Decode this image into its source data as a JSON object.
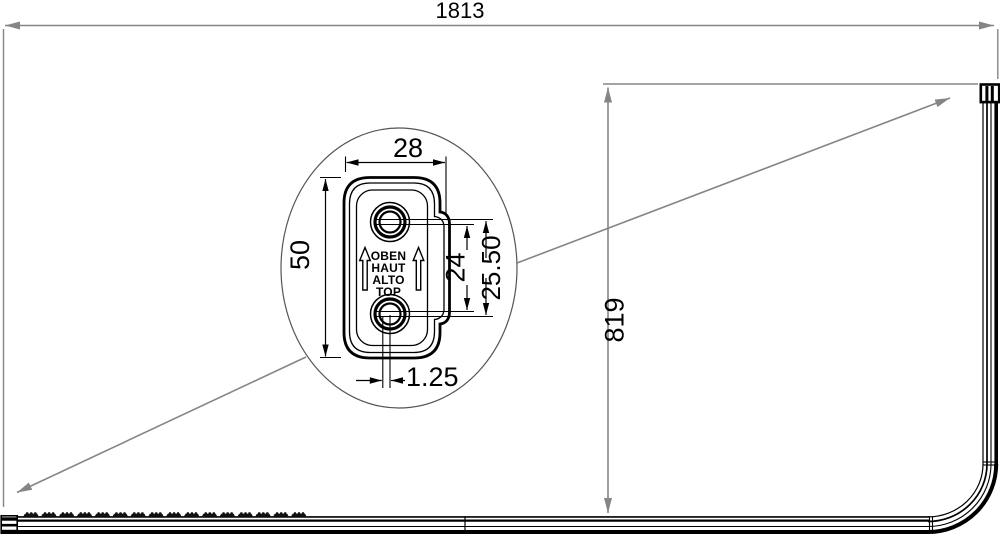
{
  "dims": {
    "total_width": "1813",
    "total_height": "819",
    "detail_width": "28",
    "detail_height": "50",
    "hole_spacing_inner": "24",
    "hole_spacing_outer": "25.50",
    "hole_offset": "1.25"
  },
  "marking": {
    "lines": [
      "OBEN",
      "HAUT",
      "ALTO",
      "TOP"
    ]
  },
  "rail": {
    "glider_count": 16
  },
  "colors": {
    "dim_line": "#858585",
    "drawing_line": "#000000",
    "background": "#ffffff"
  }
}
